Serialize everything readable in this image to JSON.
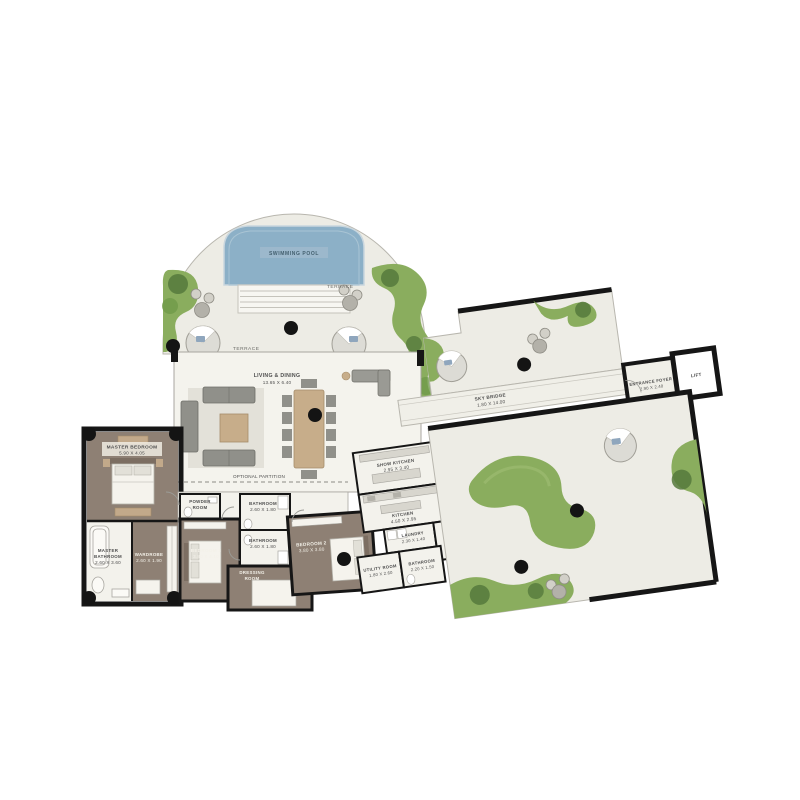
{
  "plan": {
    "pool": {
      "label": "SWIMMING POOL"
    },
    "terrace_upper": "TERRACE",
    "terrace_lower": "TERRACE",
    "living": {
      "l1": "LIVING & DINING",
      "l2": "13.65 X 6.40"
    },
    "partition": "OPTIONAL PARTITION",
    "master_bedroom": {
      "l1": "MASTER BEDROOM",
      "l2": "5.90 X 4.05"
    },
    "master_bathroom": {
      "l1": "MASTER",
      "l2": "BATHROOM",
      "l3": "2.60 X 3.60"
    },
    "wardrobe_master": {
      "l1": "WARDROBE",
      "l2": "2.60 X 1.90"
    },
    "powder": {
      "l1": "POWDER",
      "l2": "ROOM"
    },
    "bedroom3": {
      "l1": "BEDROOM 3",
      "l2": "3.80 X 4.10"
    },
    "bathroom_a": {
      "l1": "BATHROOM",
      "l2": "2.60 X 1.80"
    },
    "bathroom_b": {
      "l1": "BATHROOM",
      "l2": "2.60 X 1.80"
    },
    "dressing": {
      "l1": "DRESSING",
      "l2": "ROOM"
    },
    "bedroom2": {
      "l1": "BEDROOM 2",
      "l2": "3.80 X 3.80"
    },
    "utility": {
      "l1": "UTILITY ROOM",
      "l2": "1.80 X 2.60"
    },
    "bathroom_c": {
      "l1": "BATHROOM",
      "l2": "2.20 X 1.50"
    },
    "laundry": {
      "l1": "LAUNDRY",
      "l2": "2.30 X 1.40"
    },
    "kitchen": {
      "l1": "KITCHEN",
      "l2": "4.50 X 2.95"
    },
    "show_kitchen": {
      "l1": "SHOW KITCHEN",
      "l2": "2.95 X 3.40"
    },
    "storage": {
      "l1": "STORAGE"
    },
    "sky_bridge": {
      "l1": "SKY BRIDGE",
      "l2": "1.80 X 14.00"
    },
    "entrance_foyer": {
      "l1": "ENTRANCE FOYER",
      "l2": "2.90 X 2.40"
    },
    "lift": {
      "l1": "LIFT"
    }
  },
  "colors": {
    "floor_light": "#f2f1ea",
    "terrace": "#edece5",
    "floor_brown": "#8e8074",
    "pool_blue": "#8cb0c7",
    "garden_green": "#8aad5e",
    "shrub_green": "#55793c",
    "wall_black": "#161616",
    "wood": "#c7ad8a",
    "sofa_grey": "#90908a"
  }
}
